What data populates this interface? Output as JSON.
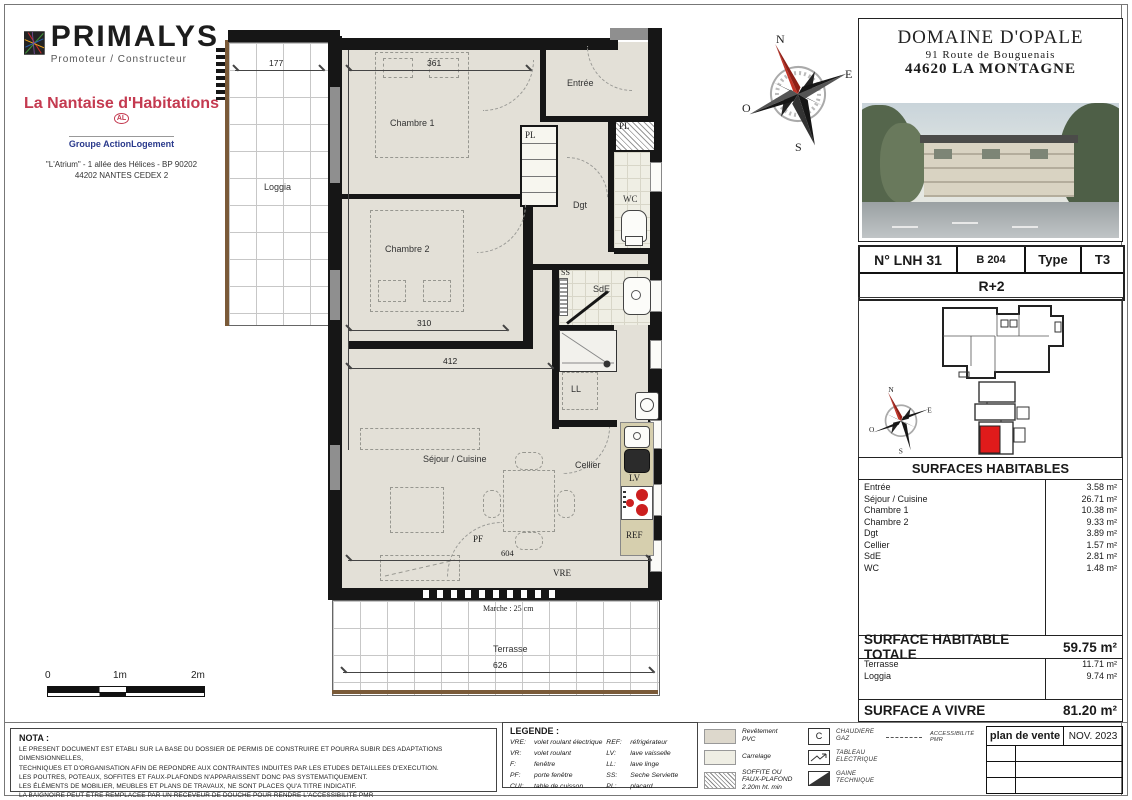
{
  "branding": {
    "primalys": "PRIMALYS",
    "primalys_tagline": "Promoteur / Constructeur",
    "nantaise": "La Nantaise d'Habitations",
    "nantaise_badge": "AL",
    "groupe": "Groupe ActionLogement",
    "address_line1": "\"L'Atrium\" - 1 allée des Hélices - BP 90202",
    "address_line2": "44202 NANTES CEDEX 2"
  },
  "project": {
    "name": "DOMAINE D'OPALE",
    "street": "91 Route de Bouguenais",
    "city": "44620 LA MONTAGNE"
  },
  "unit": {
    "number": "N° LNH 31",
    "ref": "B 204",
    "type_label": "Type",
    "type_value": "T3",
    "floor": "R+2"
  },
  "compass": {
    "n": "N",
    "e": "E",
    "s": "S",
    "o": "O"
  },
  "plan": {
    "rooms": {
      "loggia": "Loggia",
      "chambre1": "Chambre 1",
      "entree": "Entrée",
      "wc": "WC",
      "dgt": "Dgt",
      "chambre2": "Chambre 2",
      "sde": "SdE",
      "ss": "SS",
      "cellier": "Cellier",
      "ll": "LL",
      "sejour": "Séjour / Cuisine",
      "terrasse": "Terrasse"
    },
    "fixtures": {
      "pl_center": "PL",
      "pl_right": "PL",
      "lv": "LV",
      "ref": "REF",
      "pf": "PF",
      "vre": "VRE"
    },
    "dims": {
      "loggia_w": "177",
      "chambre1_w": "361",
      "chambre2_w": "310",
      "sejour_w": "412",
      "pf_w": "604",
      "terrasse_w": "626",
      "marche": "Marche : 25 cm"
    }
  },
  "surfaces": {
    "title": "SURFACES HABITABLES",
    "rows": [
      {
        "label": "Entrée",
        "value": "3.58 m²"
      },
      {
        "label": "Séjour / Cuisine",
        "value": "26.71 m²"
      },
      {
        "label": "Chambre 1",
        "value": "10.38 m²"
      },
      {
        "label": "Chambre 2",
        "value": "9.33 m²"
      },
      {
        "label": "Dgt",
        "value": "3.89 m²"
      },
      {
        "label": "Cellier",
        "value": "1.57 m²"
      },
      {
        "label": "SdE",
        "value": "2.81 m²"
      },
      {
        "label": "WC",
        "value": "1.48 m²"
      }
    ]
  },
  "totals": {
    "total_label": "SURFACE HABITABLE TOTALE",
    "total_value": "59.75 m²",
    "extras": [
      {
        "label": "Terrasse",
        "value": "11.71 m²"
      },
      {
        "label": "Loggia",
        "value": "9.74 m²"
      }
    ],
    "vivre_label": "SURFACE A VIVRE",
    "vivre_value": "81.20 m²"
  },
  "nota": {
    "title": "NOTA :",
    "lines": [
      "LE PRESENT DOCUMENT EST ETABLI SUR LA BASE DU DOSSIER DE PERMIS DE CONSTRUIRE ET POURRA SUBIR DES ADAPTATIONS DIMENSIONNELLES,",
      "TECHNIQUES ET D'ORGANISATION AFIN DE REPONDRE AUX CONTRAINTES INDUITES PAR LES ETUDES DETAILLEES D'EXECUTION.",
      "LES POUTRES, POTEAUX, SOFFITES ET FAUX-PLAFONDS N'APPARAISSENT DONC PAS SYSTEMATIQUEMENT.",
      "LES ÉLÉMENTS DE MOBILIER, MEUBLES ET PLANS DE TRAVAUX, NE SONT PLACES QU'A TITRE INDICATIF.",
      "LA BAIGNOIRE PEUT ÊTRE REMPLACEE PAR UN RECEVEUR DE DOUCHE POUR RENDRE L'ACCESSIBILITÉ PMR"
    ]
  },
  "legende": {
    "title": "LEGENDE :",
    "col1": [
      {
        "abbr": "VRE:",
        "def": "volet roulant électrique"
      },
      {
        "abbr": "VR:",
        "def": "volet roulant"
      },
      {
        "abbr": "F:",
        "def": "fenêtre"
      },
      {
        "abbr": "PF:",
        "def": "porte fenêtre"
      },
      {
        "abbr": "CUI:",
        "def": "table de cuisson"
      }
    ],
    "col2": [
      {
        "abbr": "REF:",
        "def": "réfrigérateur"
      },
      {
        "abbr": "LV:",
        "def": "lave vaisselle"
      },
      {
        "abbr": "LL:",
        "def": "lave linge"
      },
      {
        "abbr": "SS:",
        "def": "Seche Serviette"
      },
      {
        "abbr": "PL:",
        "def": "placard"
      }
    ]
  },
  "materials": {
    "pvc_line1": "Revêtement",
    "pvc_line2": "PVC",
    "carrelage": "Carrelage",
    "soffite_line1": "SOFFITE OU",
    "soffite_line2": "FAUX-PLAFOND",
    "soffite_line3": "2.20m ht. min"
  },
  "symbols": {
    "chaudiere_line1": "CHAUDIERE",
    "chaudiere_line2": "GAZ",
    "chaudiere_glyph": "C",
    "tableau_line1": "TABLEAU",
    "tableau_line2": "ELECTRIQUE",
    "gaine_line1": "GAINE",
    "gaine_line2": "TECHNIQUE",
    "pmr": "ACCESSIBILITÉ PMR"
  },
  "titleblock": {
    "doc": "plan de vente",
    "date": "NOV. 2023"
  },
  "scalebar": {
    "t0": "0",
    "t1": "1m",
    "t2": "2m"
  },
  "colors": {
    "accent_red": "#cc1f1f",
    "nantaise_red": "#c43a50",
    "groupe_blue": "#2a3a8c",
    "wall_black": "#161616",
    "room_beige": "#e3e0d7",
    "kitchen_tan": "#d6cfae"
  }
}
